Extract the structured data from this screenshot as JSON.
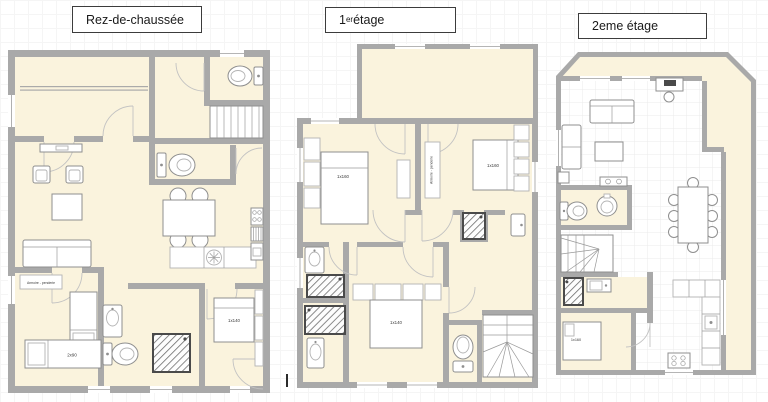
{
  "title_labels": {
    "rdc": "Rez-de-chaussée",
    "etage1_num": "1",
    "etage1_sup": "er",
    "etage1_rest": " étage",
    "etage2": "2eme étage"
  },
  "bed_labels": {
    "rdc_bunk": "2x90",
    "rdc_right": "1x140",
    "e1_left": "1x160",
    "e1_right": "1x160",
    "e1_center": "1x140",
    "e2_bedroom": "1x160"
  },
  "closet_labels": {
    "rdc": "Armoire - penderie",
    "etage1": "Armoire - penderie"
  },
  "colors": {
    "wall": "#a9a9a9",
    "room_fill": "#faf3dd",
    "floor_tile": "#ffffff",
    "furniture_stroke": "#8f8f8f",
    "shower_hatch": "#6e6e6e",
    "background_grid": "#f5f5f5",
    "label_border": "#3c3c3c"
  }
}
